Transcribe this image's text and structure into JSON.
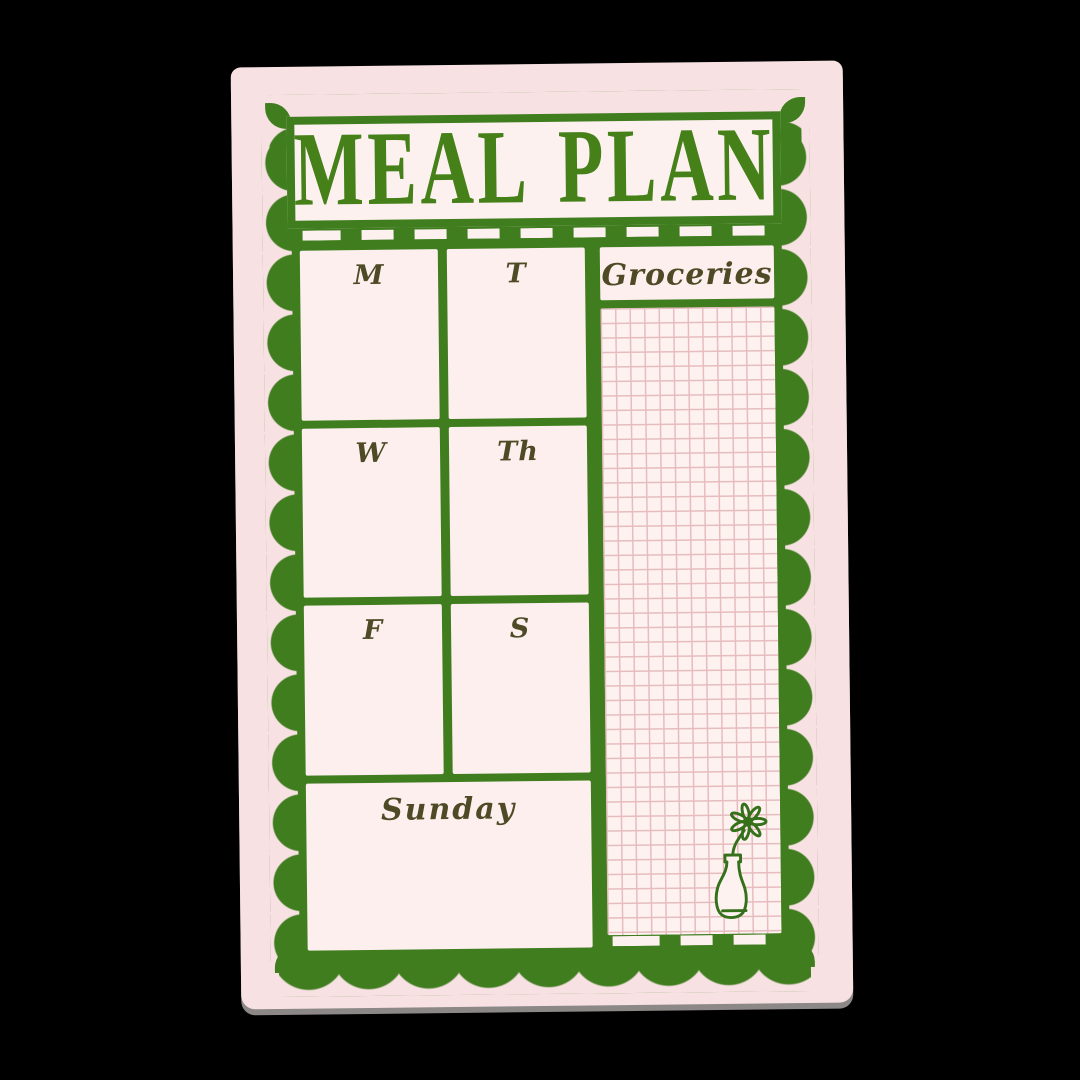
{
  "notepad": {
    "title": "MEAL PLAN",
    "days": [
      {
        "id": "monday",
        "label": "M"
      },
      {
        "id": "tuesday",
        "label": "T"
      },
      {
        "id": "wednesday",
        "label": "W"
      },
      {
        "id": "thursday",
        "label": "Th"
      },
      {
        "id": "friday",
        "label": "F"
      },
      {
        "id": "saturday",
        "label": "S"
      }
    ],
    "sunday": {
      "label": "Sunday"
    },
    "groceries": {
      "label": "Groceries"
    },
    "decor": {
      "vase_icon": "flower-in-vase-icon"
    },
    "colors": {
      "background": "#000000",
      "paper_pink": "#f8e1e3",
      "cell_pink": "#fcefed",
      "ink_green": "#3f7d1e",
      "title_green": "#458019",
      "text_olive": "#4e4a26",
      "grid_line_pink": "#e7bcbf"
    }
  }
}
